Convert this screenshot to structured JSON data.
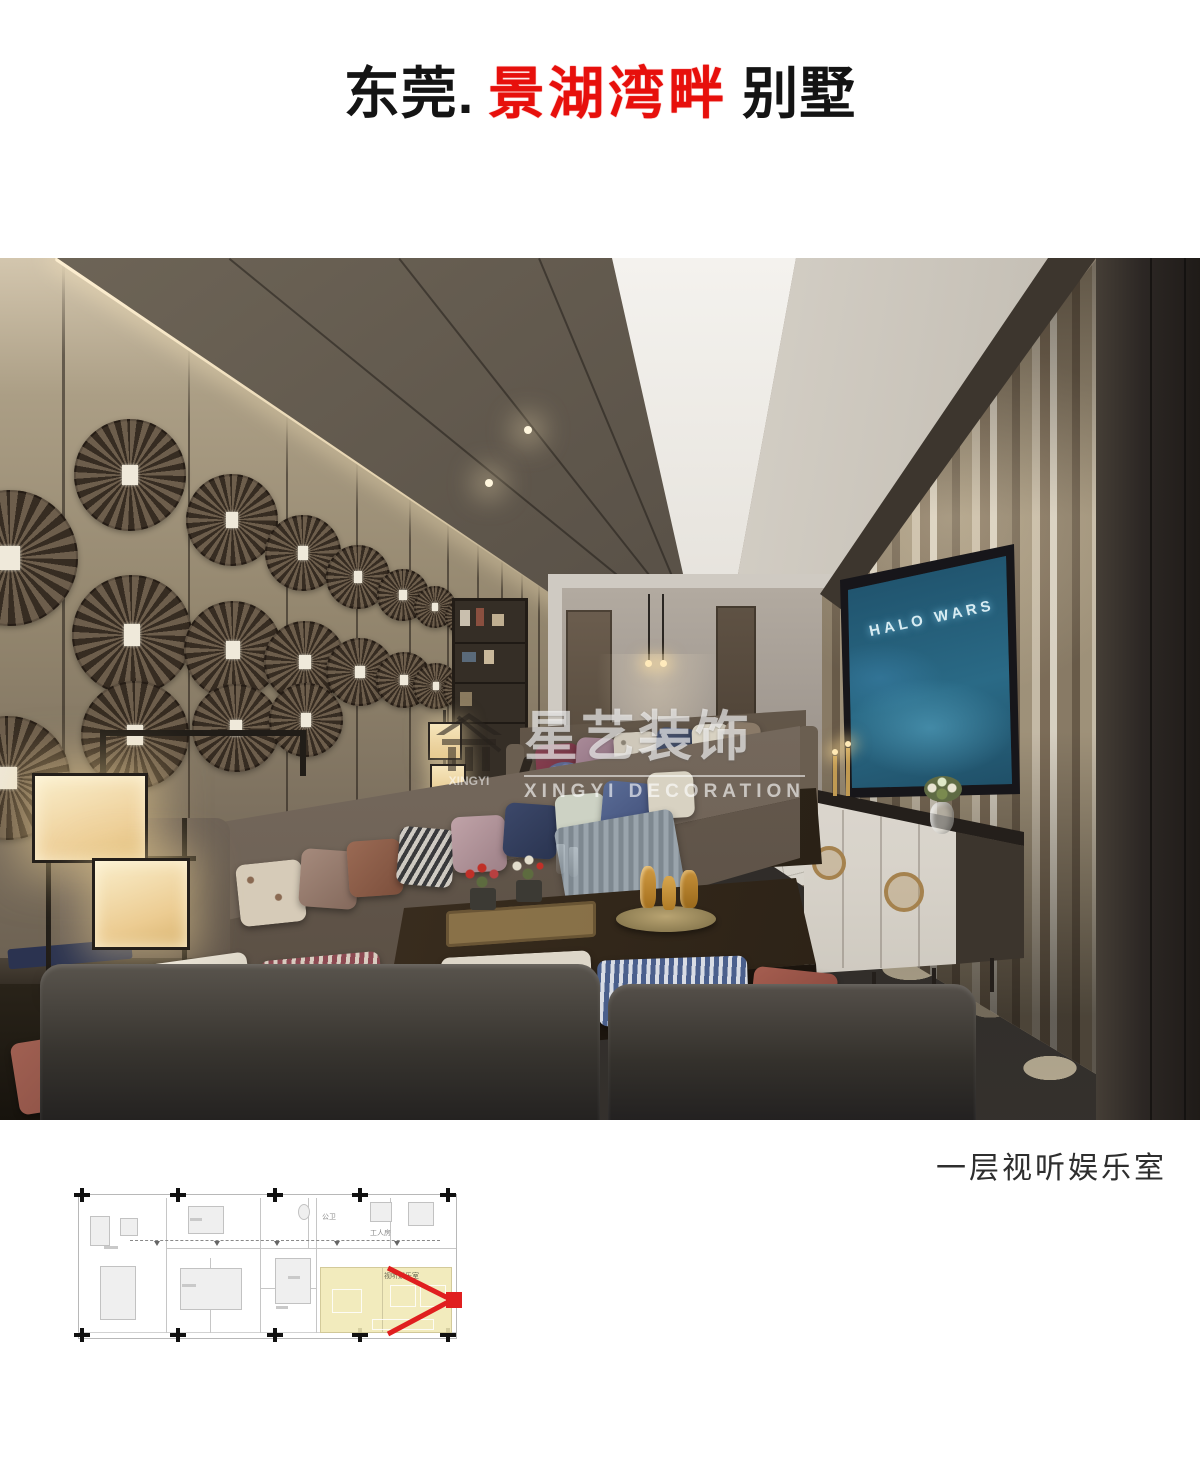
{
  "title": {
    "city": "东莞.",
    "project_red": "景湖湾畔",
    "type": "别墅",
    "red_color": "#e7100c"
  },
  "watermark": {
    "brand_cn": "星艺装饰",
    "brand_en": "XINGYI DECORATION",
    "logo_text": "XINGYI"
  },
  "photo": {
    "tv_screen_title": "HALO WARS"
  },
  "caption": {
    "text": "一层视听娱乐室"
  },
  "floor_plan": {
    "room_highlight_label": "视听娱乐室",
    "label_bath": "公卫",
    "label_maid_room": "工人房",
    "highlight_color": "#f1e9bc",
    "marker_color": "#e01f1f"
  },
  "colors": {
    "page_bg": "#ffffff",
    "title_text": "#141414",
    "caption_text": "#2e2e2e",
    "ceiling_dark": "#57504a",
    "wall_taupe": "#9c8f7b",
    "carpet_base": "#3b3733",
    "tv_screen_blue": "#1c4a63"
  }
}
